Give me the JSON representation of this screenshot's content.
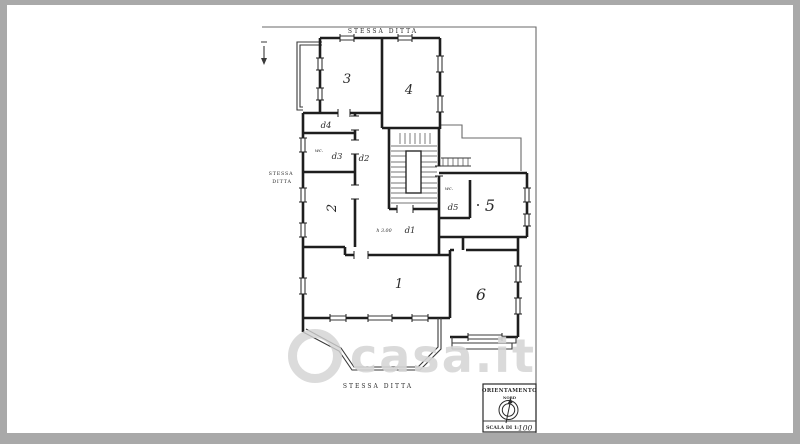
{
  "palette": {
    "frame_gray": "#a9a9a9",
    "page_white": "#ffffff",
    "ink_dark": "#1e1e1e",
    "boundary_gray": "#6a6a6a",
    "watermark_gray": "#d6d6d6"
  },
  "plan": {
    "site_labels": {
      "top": "STESSA DITTA",
      "left_line1": "STESSA",
      "left_line2": "DITTA",
      "bottom": "STESSA DITTA"
    },
    "room_labels": {
      "room1": "1",
      "room2": "2",
      "room3": "3",
      "room4": "4",
      "room5": "5",
      "room6": "6",
      "hall_d1": "d1",
      "corridor_d2": "d2",
      "room_d3": "d3",
      "room_d4": "d4",
      "room_d5": "d5",
      "wc_left": "wc.",
      "wc_right": "wc.",
      "ceiling_height": "h 3.00"
    },
    "orientation_box": {
      "title": "ORIENTAMENTO",
      "north": "NORD",
      "scale_prefix": "SCALA DI 1:",
      "scale_value": "100"
    }
  },
  "watermark": {
    "text": "casa.it"
  }
}
